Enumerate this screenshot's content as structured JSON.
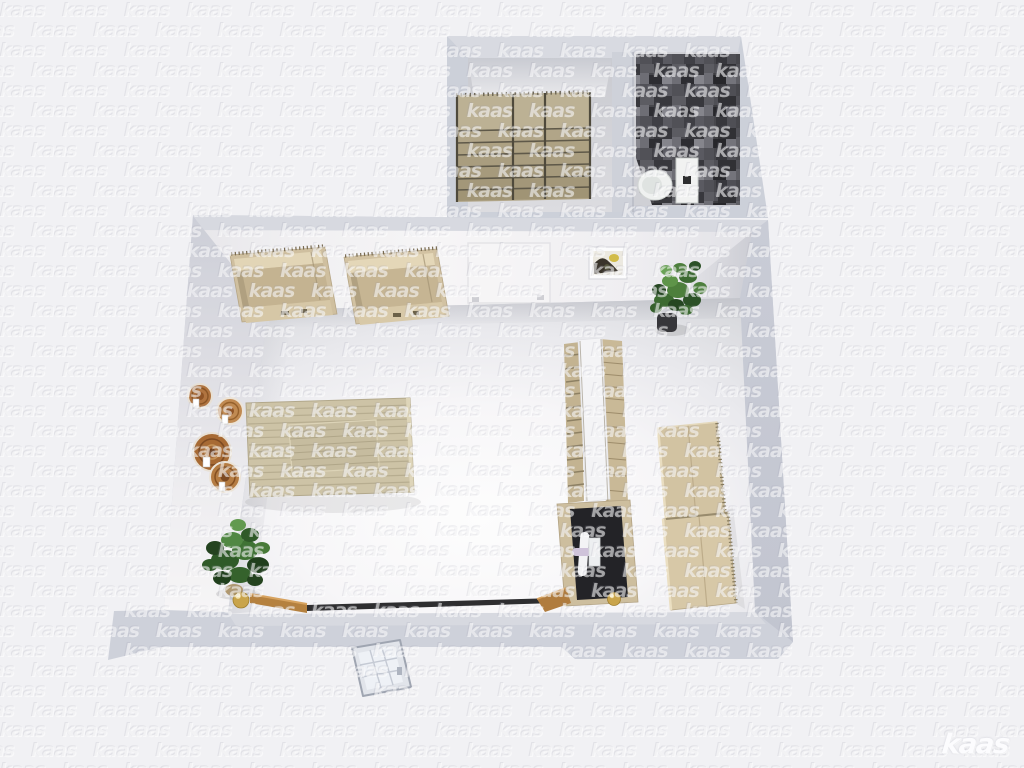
{
  "watermark": {
    "text": "kaas"
  },
  "logo": {
    "text": "kaas"
  },
  "scene": {
    "type": "3d-floorplan-top-down-render",
    "rooms": [
      {
        "name": "main-room"
      },
      {
        "name": "storage-room"
      },
      {
        "name": "bathroom"
      }
    ],
    "objects": [
      "storage-shelving-unit",
      "bathroom-tile-wall",
      "toilet",
      "wall-cabinet-left",
      "wall-cabinet-right",
      "framed-picture",
      "door-outline-on-wall",
      "decorative-plates",
      "slatted-table",
      "potted-plant-top",
      "potted-plant-bottom",
      "tall-shelf-unit",
      "desk-black-top",
      "right-wall-cabinet-upper",
      "right-wall-cabinet-lower",
      "low-bench-rail",
      "gold-sphere-left",
      "gold-sphere-right",
      "open-entry-door"
    ],
    "colors": {
      "background": "#f1f1f4",
      "wall": "#ced1da",
      "wall_face_light": "#f4f3f5",
      "floor": "#f8f8fa",
      "wood": "#cfc0a0",
      "shelf_wood": "#b3a78a",
      "tile_dark": "#47474c",
      "plant_green": "#3f6d35",
      "accent_gold": "#c9a44b",
      "desk_top_black": "#232327",
      "toilet_white": "#eff1f0"
    }
  }
}
